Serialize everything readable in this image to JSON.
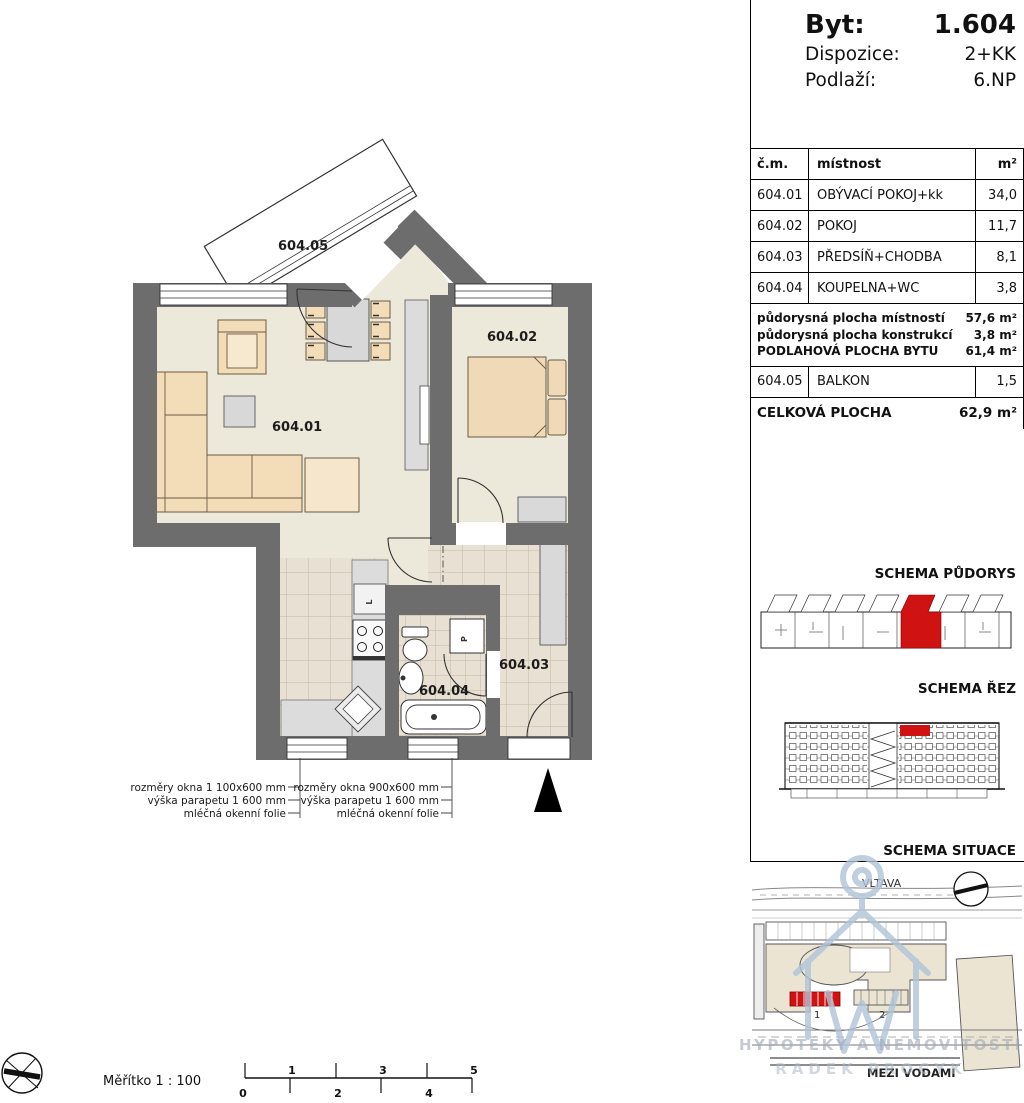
{
  "header": {
    "byt_label": "Byt:",
    "byt_value": "1.604",
    "dispozice_label": "Dispozice:",
    "dispozice_value": "2+KK",
    "podlazi_label": "Podlaží:",
    "podlazi_value": "6.NP"
  },
  "table": {
    "headers": {
      "num": "č.m.",
      "room": "místnost",
      "area": "m²"
    },
    "rows": [
      {
        "num": "604.01",
        "room": "OBÝVACÍ POKOJ+kk",
        "area": "34,0"
      },
      {
        "num": "604.02",
        "room": "POKOJ",
        "area": "11,7"
      },
      {
        "num": "604.03",
        "room": "PŘEDSÍŇ+CHODBA",
        "area": "8,1"
      },
      {
        "num": "604.04",
        "room": "KOUPELNA+WC",
        "area": "3,8"
      }
    ],
    "summary": [
      {
        "label": "půdorysná plocha místností",
        "value": "57,6 m²"
      },
      {
        "label": "půdorysná plocha konstrukcí",
        "value": "3,8 m²"
      },
      {
        "label": "PODLAHOVÁ PLOCHA BYTU",
        "value": "61,4 m²"
      }
    ],
    "balcony_row": {
      "num": "604.05",
      "room": "BALKON",
      "area": "1,5"
    },
    "total": {
      "label": "CELKOVÁ PLOCHA",
      "value": "62,9 m²"
    }
  },
  "schemas": {
    "pudorys_label": "SCHEMA PŮDORYS",
    "rez_label": "SCHEMA ŘEZ",
    "situace_label": "SCHEMA SITUACE",
    "river_label": "VLTAVA",
    "street_label": "MEZI VODAMI",
    "building1_label": "1",
    "building2_label": "2"
  },
  "plan": {
    "labels": {
      "balcony": "604.05",
      "living": "604.01",
      "bedroom": "604.02",
      "hall": "604.03",
      "bathroom": "604.04",
      "fridge": "L",
      "washer": "P"
    },
    "window_note_left": [
      "rozměry okna 1 100x600 mm",
      "výška parapetu 1 600 mm",
      "mléčná okenní folie"
    ],
    "window_note_right": [
      "rozměry okna 900x600 mm",
      "výška parapetu 1 600 mm",
      "mléčná okenní folie"
    ],
    "scale_label": "Měřítko  1 : 100",
    "scale_ticks": [
      "0",
      "1",
      "2",
      "3",
      "4",
      "5"
    ]
  },
  "watermark": {
    "line1": "HYPOTÉKY A NEMOVITOSTI",
    "line2": "RADEK PROCYK"
  },
  "colors": {
    "wall": "#6d6d6d",
    "floor": "#ece9da",
    "tile": "#e8e1d3",
    "furniture": "#f3ddb9",
    "gray_furniture": "#d9d9d9",
    "highlight_red": "#cf1212",
    "watermark_blue": "#b0c4d8"
  }
}
